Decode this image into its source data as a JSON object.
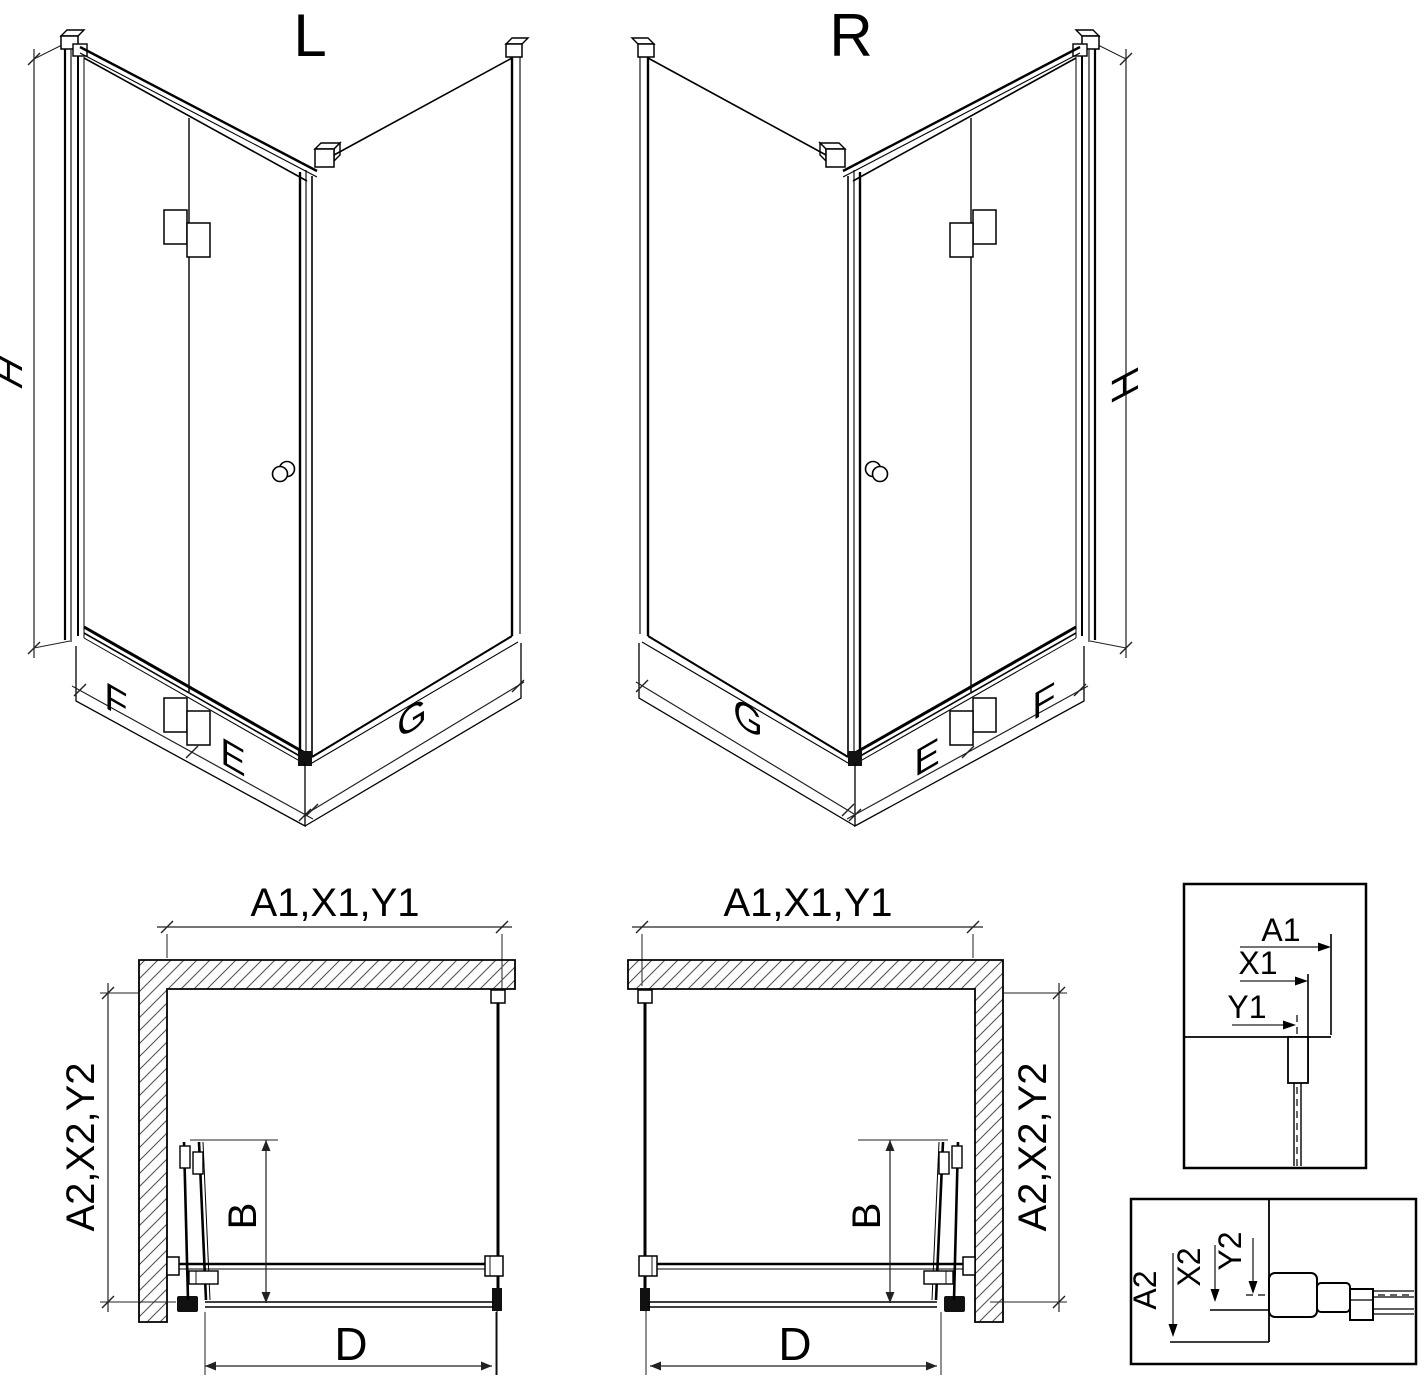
{
  "variants": {
    "left": "L",
    "right": "R"
  },
  "iso_left": {
    "height": "H",
    "front_fixed": "F",
    "front_door": "E",
    "side": "G"
  },
  "iso_right": {
    "height": "H",
    "front_fixed": "F",
    "front_door": "E",
    "side": "G"
  },
  "plan_left": {
    "width": "A1,X1,Y1",
    "depth": "A2,X2,Y2",
    "door": "B",
    "opening": "D"
  },
  "plan_right": {
    "width": "A1,X1,Y1",
    "depth": "A2,X2,Y2",
    "door": "B",
    "opening": "D"
  },
  "detail_width": {
    "wall": "A1",
    "profile": "X1",
    "glass": "Y1"
  },
  "detail_depth": {
    "wall": "A2",
    "profile": "X2",
    "glass": "Y2"
  },
  "colors": {
    "line": "#000000",
    "dim_line": "#222222",
    "hatch": "#555555",
    "background": "#ffffff"
  }
}
